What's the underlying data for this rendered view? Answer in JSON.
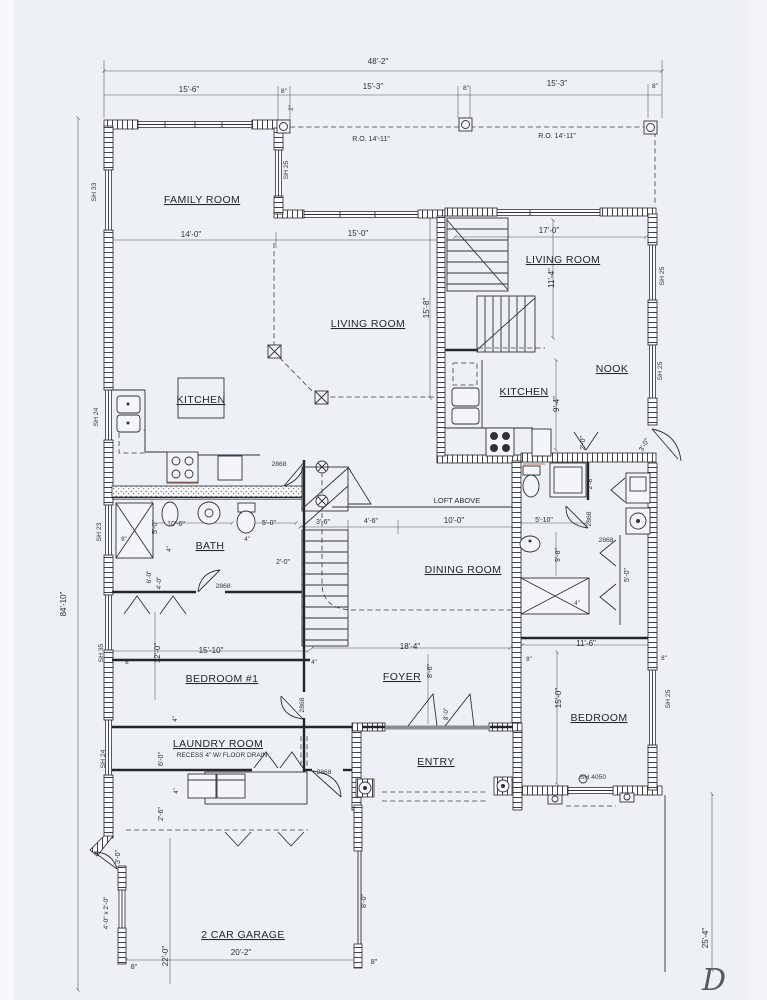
{
  "plan": {
    "rooms": [
      {
        "t": "FAMILY ROOM",
        "x": 202,
        "y": 203
      },
      {
        "t": "LIVING ROOM",
        "x": 368,
        "y": 327
      },
      {
        "t": "LIVING ROOM",
        "x": 563,
        "y": 263
      },
      {
        "t": "KITCHEN",
        "x": 201,
        "y": 403
      },
      {
        "t": "KITCHEN",
        "x": 524,
        "y": 395
      },
      {
        "t": "NOOK",
        "x": 612,
        "y": 372
      },
      {
        "t": "BATH",
        "x": 210,
        "y": 549
      },
      {
        "t": "DINING ROOM",
        "x": 463,
        "y": 573
      },
      {
        "t": "BEDROOM #1",
        "x": 222,
        "y": 682
      },
      {
        "t": "FOYER",
        "x": 402,
        "y": 680
      },
      {
        "t": "ENTRY",
        "x": 436,
        "y": 765
      },
      {
        "t": "LAUNDRY ROOM",
        "x": 218,
        "y": 747
      },
      {
        "t": "BEDROOM",
        "x": 599,
        "y": 721
      },
      {
        "t": "2 CAR GARAGE",
        "x": 243,
        "y": 938
      }
    ],
    "dimensions": [
      {
        "t": "48'-2\"",
        "x": 378,
        "y": 64
      },
      {
        "t": "15'-6\"",
        "x": 189,
        "y": 92
      },
      {
        "t": "8\"",
        "x": 284,
        "y": 93,
        "s": 6.5
      },
      {
        "t": "15'-3\"",
        "x": 373,
        "y": 89
      },
      {
        "t": "8\"",
        "x": 466,
        "y": 90,
        "s": 6.5
      },
      {
        "t": "15'-3\"",
        "x": 557,
        "y": 86
      },
      {
        "t": "8\"",
        "x": 655,
        "y": 88,
        "s": 6.5
      },
      {
        "t": "2\"",
        "x": 293,
        "y": 108,
        "r": -90,
        "s": 6
      },
      {
        "t": "R.O. 14'-11\"",
        "x": 371,
        "y": 141,
        "s": 7
      },
      {
        "t": "R.O. 14'-11\"",
        "x": 557,
        "y": 138,
        "s": 7
      },
      {
        "t": "14'-0\"",
        "x": 191,
        "y": 237
      },
      {
        "t": "15'-0\"",
        "x": 358,
        "y": 236
      },
      {
        "t": "17'-0\"",
        "x": 549,
        "y": 233
      },
      {
        "t": "11'-4\"",
        "x": 554,
        "y": 278,
        "r": -90
      },
      {
        "t": "15'-8\"",
        "x": 429,
        "y": 308,
        "r": -90
      },
      {
        "t": "9'-4\"",
        "x": 559,
        "y": 404,
        "r": -90
      },
      {
        "t": "2'-0\"",
        "x": 585,
        "y": 443,
        "r": -90,
        "s": 7
      },
      {
        "t": "3'-0\"",
        "x": 646,
        "y": 446,
        "r": -60,
        "s": 7
      },
      {
        "t": "LOFT ABOVE",
        "x": 457,
        "y": 503,
        "s": 7.5
      },
      {
        "t": "3'-6\"",
        "x": 323,
        "y": 524,
        "s": 7
      },
      {
        "t": "4'-6\"",
        "x": 371,
        "y": 523,
        "s": 7
      },
      {
        "t": "10'-0\"",
        "x": 454,
        "y": 523
      },
      {
        "t": "10'-6\"",
        "x": 176,
        "y": 526,
        "s": 7
      },
      {
        "t": "5'-0\"",
        "x": 157,
        "y": 527,
        "r": -90,
        "s": 7
      },
      {
        "t": "5'-0\"",
        "x": 269,
        "y": 525,
        "s": 7
      },
      {
        "t": "8\"",
        "x": 124,
        "y": 541,
        "s": 6
      },
      {
        "t": "4\"",
        "x": 171,
        "y": 549,
        "r": -90,
        "s": 6
      },
      {
        "t": "4\"",
        "x": 247,
        "y": 541,
        "s": 6
      },
      {
        "t": "2'-0\"",
        "x": 283,
        "y": 564,
        "s": 7
      },
      {
        "t": "6'-0\"",
        "x": 151,
        "y": 577,
        "r": -90,
        "s": 6.5
      },
      {
        "t": "4'-0\"",
        "x": 161,
        "y": 583,
        "r": -90,
        "s": 6.5
      },
      {
        "t": "5'-10\"",
        "x": 544,
        "y": 522,
        "s": 7
      },
      {
        "t": "9'-8\"",
        "x": 560,
        "y": 555,
        "r": -90,
        "s": 7
      },
      {
        "t": "2'-8\"",
        "x": 592,
        "y": 483,
        "r": -90,
        "s": 6.5
      },
      {
        "t": "5'-0\"",
        "x": 629,
        "y": 575,
        "r": -90,
        "s": 7
      },
      {
        "t": "4\"",
        "x": 577,
        "y": 605,
        "s": 6
      },
      {
        "t": "15'-10\"",
        "x": 211,
        "y": 653
      },
      {
        "t": "12'-0\"",
        "x": 160,
        "y": 653,
        "r": -90
      },
      {
        "t": "8\"",
        "x": 128,
        "y": 664,
        "s": 6
      },
      {
        "t": "4\"",
        "x": 314,
        "y": 664,
        "s": 6
      },
      {
        "t": "4\"",
        "x": 177,
        "y": 719,
        "r": -90,
        "s": 6
      },
      {
        "t": "18'-4\"",
        "x": 410,
        "y": 649
      },
      {
        "t": "8'-6\"",
        "x": 432,
        "y": 671,
        "r": -90,
        "s": 7
      },
      {
        "t": "8'-0\"",
        "x": 448,
        "y": 714,
        "r": -90,
        "s": 6
      },
      {
        "t": "11'-6\"",
        "x": 586,
        "y": 646
      },
      {
        "t": "8\"",
        "x": 529,
        "y": 661,
        "s": 6
      },
      {
        "t": "8\"",
        "x": 664,
        "y": 660,
        "s": 6
      },
      {
        "t": "15'-0\"",
        "x": 561,
        "y": 698,
        "r": -90
      },
      {
        "t": "6'-0\"",
        "x": 163,
        "y": 759,
        "r": -90,
        "s": 7
      },
      {
        "t": "4\"",
        "x": 178,
        "y": 791,
        "r": -90,
        "s": 6
      },
      {
        "t": "2'-6\"",
        "x": 163,
        "y": 814,
        "r": -90,
        "s": 7
      },
      {
        "t": "3'-0\"",
        "x": 120,
        "y": 857,
        "r": -90,
        "s": 7
      },
      {
        "t": "4'-0\" x 2'-0\"",
        "x": 108,
        "y": 913,
        "r": -90,
        "s": 6.5
      },
      {
        "t": "8\"",
        "x": 134,
        "y": 969,
        "s": 7
      },
      {
        "t": "22'-0\"",
        "x": 168,
        "y": 956,
        "r": -90
      },
      {
        "t": "20'-2\"",
        "x": 241,
        "y": 955
      },
      {
        "t": "8'-0\"",
        "x": 366,
        "y": 901,
        "r": -90,
        "s": 7
      },
      {
        "t": "8\"",
        "x": 374,
        "y": 964,
        "s": 7
      },
      {
        "t": "25'-4\"",
        "x": 708,
        "y": 938,
        "r": -90
      },
      {
        "t": "84'-10\"",
        "x": 66,
        "y": 604,
        "r": -90
      }
    ],
    "windows": [
      {
        "t": "SH 33",
        "x": 96,
        "y": 192,
        "r": -90
      },
      {
        "t": "SH 25",
        "x": 288,
        "y": 170,
        "r": -90
      },
      {
        "t": "SH 24",
        "x": 98,
        "y": 417,
        "r": -90
      },
      {
        "t": "SH 23",
        "x": 101,
        "y": 532,
        "r": -90
      },
      {
        "t": "SH 35",
        "x": 103,
        "y": 653,
        "r": -90
      },
      {
        "t": "SH 24",
        "x": 105,
        "y": 759,
        "r": -90
      },
      {
        "t": "SH 25",
        "x": 664,
        "y": 276,
        "r": -90
      },
      {
        "t": "SH 25",
        "x": 662,
        "y": 371,
        "r": -90
      },
      {
        "t": "SH 25",
        "x": 670,
        "y": 699,
        "r": -90
      },
      {
        "t": "SH 4050",
        "x": 593,
        "y": 779
      }
    ],
    "doors": [
      {
        "t": "2868",
        "x": 279,
        "y": 466
      },
      {
        "t": "2868",
        "x": 223,
        "y": 588
      },
      {
        "t": "2868",
        "x": 304,
        "y": 705,
        "r": -90
      },
      {
        "t": "2868",
        "x": 324,
        "y": 774
      },
      {
        "t": "2868",
        "x": 591,
        "y": 519,
        "r": -90
      },
      {
        "t": "2868",
        "x": 606,
        "y": 542
      }
    ],
    "notes": [
      {
        "t": "RECESS 4\" W/ FLOOR DRAIN",
        "x": 222,
        "y": 757,
        "s": 6.5
      },
      {
        "t": "D",
        "x": 714,
        "y": 990,
        "s": 30,
        "cls": "script"
      }
    ]
  }
}
